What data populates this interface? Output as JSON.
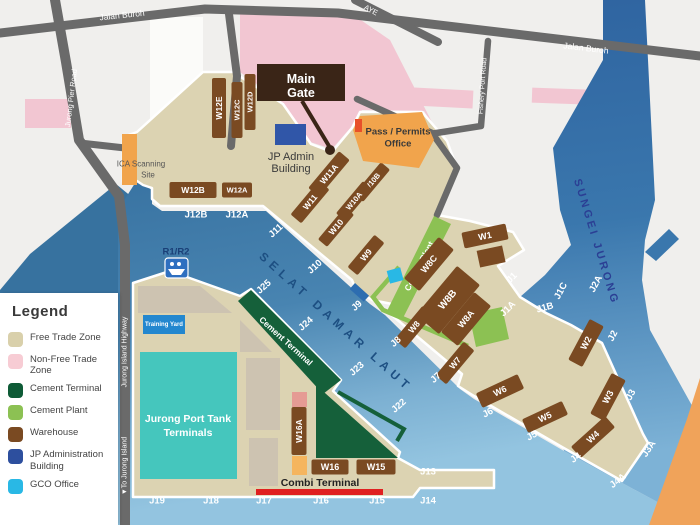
{
  "title": "Jurong Port Map",
  "colors": {
    "bg": "#f0efed",
    "white_block": "#fbfbf9",
    "land": "#dcd3b2",
    "land_stroke": "#ffffff",
    "water_west": "#37729f",
    "water_deep": "#36709f",
    "water_mid": "#4884b1",
    "water_soft": "#7cb0d2",
    "water_light": "#93c4e0",
    "river_top": "#2c5f9d",
    "river_mid": "#3a77ad",
    "river_low": "#7db2d6",
    "road": "#6a6a6a",
    "road_text": "#ffffff",
    "pink": "#f2c6d2",
    "orange_site": "#f1a44c",
    "orange_land": "#f0a35a",
    "red_bar": "#e02020",
    "red_marker": "#e8502a",
    "cement_terminal": "#15603a",
    "cement_plant": "#8cc153",
    "warehouse": "#7a4a22",
    "main_gate": "#3a2517",
    "jp_admin": "#3056a8",
    "gco": "#29b8e5",
    "training_yard": "#2387cf",
    "tank": "#45c6bd",
    "patch": "#cdc3b1",
    "selat_text": "#1d4f82",
    "sungei_text": "#2b3f94",
    "berth_text": "#ffffff",
    "dark_text": "#3a3a3a",
    "navy_text": "#1a3f77"
  },
  "legend": {
    "title": "Legend",
    "items": [
      {
        "label": "Free Trade Zone",
        "color": "#d9d0ab"
      },
      {
        "label": "Non-Free Trade Zone",
        "color": "#f7ccd4"
      },
      {
        "label": "Cement Terminal",
        "color": "#0e5b36"
      },
      {
        "label": "Cement Plant",
        "color": "#8cc153"
      },
      {
        "label": "Warehouse",
        "color": "#7a4a22"
      },
      {
        "label": "JP Administration Building",
        "color": "#2d4f9e"
      },
      {
        "label": "GCO Office",
        "color": "#29b8e5"
      }
    ]
  },
  "roads": {
    "labels": [
      {
        "t": "Jalan Buroh",
        "x": 122,
        "y": 15,
        "r": -6,
        "fs": 8.5
      },
      {
        "t": "Jalan Buroh",
        "x": 586,
        "y": 48,
        "r": 7,
        "fs": 8.5
      },
      {
        "t": "Jurong Pier Road",
        "x": 71,
        "y": 98,
        "r": -83,
        "fs": 7.5
      },
      {
        "t": "AYE",
        "x": 371,
        "y": 10,
        "r": 28,
        "fs": 7.5
      },
      {
        "t": "Fishery Port Road",
        "x": 483,
        "y": 86,
        "r": -86,
        "fs": 7
      },
      {
        "t": "Jurong Island Highway",
        "x": 125,
        "y": 352,
        "r": -90,
        "fs": 7
      },
      {
        "t": "▼To Jurong Island",
        "x": 125,
        "y": 466,
        "r": -90,
        "fs": 7
      }
    ]
  },
  "water_labels": [
    {
      "t": "SELAT DAMAR LAUT",
      "x": 336,
      "y": 322,
      "r": 42,
      "ls": 5,
      "fs": 12,
      "colorKey": "selat_text"
    },
    {
      "t": "SUNGEI JURONG",
      "x": 596,
      "y": 242,
      "r": 73,
      "ls": 3,
      "fs": 11,
      "colorKey": "sungei_text"
    }
  ],
  "berths": [
    {
      "t": "J12B",
      "x": 196,
      "y": 215,
      "r": 0
    },
    {
      "t": "J12A",
      "x": 237,
      "y": 215,
      "r": 0
    },
    {
      "t": "J11",
      "x": 276,
      "y": 231,
      "r": -42
    },
    {
      "t": "J10",
      "x": 315,
      "y": 267,
      "r": -42
    },
    {
      "t": "J25",
      "x": 264,
      "y": 287,
      "r": -42
    },
    {
      "t": "J24",
      "x": 306,
      "y": 324,
      "r": -42
    },
    {
      "t": "J23",
      "x": 357,
      "y": 369,
      "r": -42
    },
    {
      "t": "J22",
      "x": 399,
      "y": 406,
      "r": -42
    },
    {
      "t": "J9",
      "x": 357,
      "y": 306,
      "r": -42
    },
    {
      "t": "J8",
      "x": 396,
      "y": 342,
      "r": -42
    },
    {
      "t": "J7",
      "x": 436,
      "y": 378,
      "r": -42
    },
    {
      "t": "J6",
      "x": 488,
      "y": 413,
      "r": -28
    },
    {
      "t": "J5",
      "x": 532,
      "y": 436,
      "r": -28
    },
    {
      "t": "J4",
      "x": 576,
      "y": 458,
      "r": -36
    },
    {
      "t": "J4A",
      "x": 618,
      "y": 481,
      "r": -38
    },
    {
      "t": "J3A",
      "x": 649,
      "y": 449,
      "r": -56
    },
    {
      "t": "J3",
      "x": 631,
      "y": 395,
      "r": -62
    },
    {
      "t": "J2",
      "x": 613,
      "y": 336,
      "r": -62
    },
    {
      "t": "J2A",
      "x": 596,
      "y": 284,
      "r": -62
    },
    {
      "t": "J1C",
      "x": 561,
      "y": 291,
      "r": -62
    },
    {
      "t": "J1B",
      "x": 545,
      "y": 308,
      "r": -15
    },
    {
      "t": "J1A",
      "x": 508,
      "y": 309,
      "r": -45
    },
    {
      "t": "J1",
      "x": 512,
      "y": 278,
      "r": -45
    },
    {
      "t": "J13",
      "x": 428,
      "y": 472,
      "r": 0
    },
    {
      "t": "J14",
      "x": 428,
      "y": 501,
      "r": 0
    },
    {
      "t": "J15",
      "x": 377,
      "y": 501,
      "r": 0
    },
    {
      "t": "J16",
      "x": 321,
      "y": 501,
      "r": 0
    },
    {
      "t": "J17",
      "x": 264,
      "y": 501,
      "r": 0
    },
    {
      "t": "J18",
      "x": 211,
      "y": 501,
      "r": 0
    },
    {
      "t": "J19",
      "x": 157,
      "y": 501,
      "r": 0
    }
  ],
  "warehouses": [
    {
      "t": "W12E",
      "x": 219,
      "y": 108,
      "w": 60,
      "h": 14,
      "r": -90
    },
    {
      "t": "W12C",
      "x": 237,
      "y": 110,
      "w": 56,
      "h": 11,
      "r": -90,
      "fs": 7.5
    },
    {
      "t": "W12D",
      "x": 250,
      "y": 102,
      "w": 56,
      "h": 11,
      "r": -90,
      "fs": 7.5
    },
    {
      "t": "W12B",
      "x": 193,
      "y": 190,
      "w": 47,
      "h": 16,
      "r": 0
    },
    {
      "t": "W12A",
      "x": 237,
      "y": 190,
      "w": 30,
      "h": 15,
      "r": 0,
      "fs": 7.5
    },
    {
      "t": "W11A",
      "x": 329,
      "y": 174,
      "w": 48,
      "h": 14,
      "r": -50
    },
    {
      "t": "W11",
      "x": 310,
      "y": 202,
      "w": 44,
      "h": 14,
      "r": -50
    },
    {
      "t": "W10B",
      "x": 372,
      "y": 182,
      "w": 42,
      "h": 12,
      "r": -50,
      "fs": 7.5
    },
    {
      "t": "W10A",
      "x": 354,
      "y": 201,
      "w": 42,
      "h": 12,
      "r": -50,
      "fs": 7.5
    },
    {
      "t": "W10",
      "x": 336,
      "y": 227,
      "w": 42,
      "h": 12,
      "r": -50
    },
    {
      "t": "W9",
      "x": 366,
      "y": 255,
      "w": 42,
      "h": 13,
      "r": -50
    },
    {
      "t": "W8C",
      "x": 429,
      "y": 264,
      "w": 54,
      "h": 20,
      "r": -50,
      "fs": 9
    },
    {
      "t": "W8B",
      "x": 448,
      "y": 300,
      "w": 64,
      "h": 30,
      "r": -50,
      "fs": 10
    },
    {
      "t": "W8A",
      "x": 466,
      "y": 319,
      "w": 52,
      "h": 22,
      "r": -50,
      "fs": 9
    },
    {
      "t": "W1",
      "x": 485,
      "y": 236,
      "w": 45,
      "h": 16,
      "r": -12,
      "fs": 9
    },
    {
      "t": "W8",
      "x": 414,
      "y": 327,
      "w": 44,
      "h": 14,
      "r": -50
    },
    {
      "t": "W7",
      "x": 455,
      "y": 363,
      "w": 44,
      "h": 14,
      "r": -50
    },
    {
      "t": "W6",
      "x": 500,
      "y": 391,
      "w": 46,
      "h": 16,
      "r": -25,
      "fs": 9
    },
    {
      "t": "W5",
      "x": 545,
      "y": 417,
      "w": 44,
      "h": 15,
      "r": -25,
      "fs": 9
    },
    {
      "t": "W4",
      "x": 593,
      "y": 437,
      "w": 46,
      "h": 15,
      "r": -42,
      "fs": 9
    },
    {
      "t": "W2",
      "x": 586,
      "y": 343,
      "w": 46,
      "h": 16,
      "r": -62,
      "fs": 9
    },
    {
      "t": "W3",
      "x": 608,
      "y": 397,
      "w": 46,
      "h": 16,
      "r": -62,
      "fs": 9
    },
    {
      "t": "W16A",
      "x": 299,
      "y": 431,
      "w": 48,
      "h": 15,
      "r": -90
    },
    {
      "t": "W16",
      "x": 330,
      "y": 467,
      "w": 37,
      "h": 15,
      "r": 0,
      "fs": 9
    },
    {
      "t": "W15",
      "x": 376,
      "y": 467,
      "w": 39,
      "h": 15,
      "r": 0,
      "fs": 9
    }
  ],
  "sites": {
    "main_gate": {
      "lines": [
        "Main",
        "Gate"
      ]
    },
    "jp_admin": {
      "lines": [
        "JP Admin",
        "Building"
      ]
    },
    "pass_office": {
      "lines": [
        "Pass / Permits",
        "Office"
      ]
    },
    "ica": {
      "lines": [
        "ICA Scanning",
        "Site"
      ]
    },
    "r1r2": {
      "label": "R1/R2"
    },
    "training_yard": {
      "label": "Training Yard"
    },
    "tank_terminals": {
      "lines": [
        "Jurong Port Tank",
        "Terminals"
      ]
    },
    "combi": {
      "label": "Combi Terminal"
    },
    "cement_terminal": {
      "label": "Cement Terminal"
    },
    "cement_plant": {
      "label": "Cement Plant"
    }
  }
}
